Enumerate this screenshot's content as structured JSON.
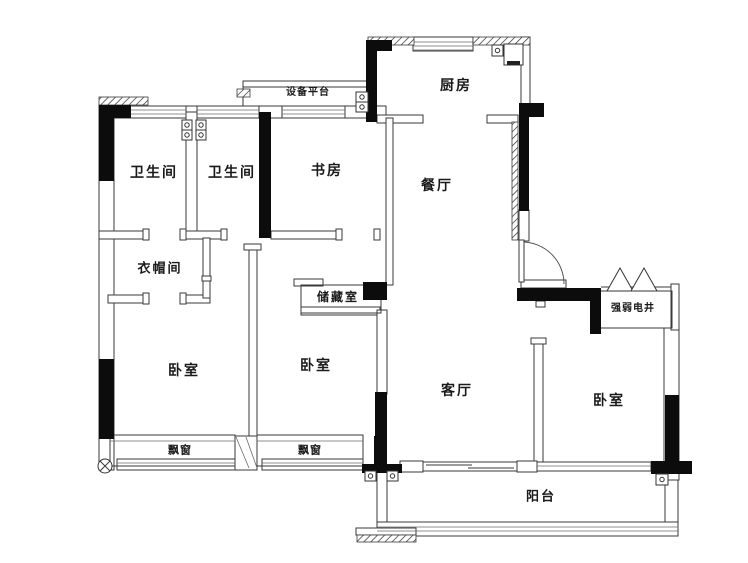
{
  "floorplan": {
    "rooms": {
      "equipment_platform": "设备平台",
      "kitchen": "厨房",
      "bathroom_1": "卫生间",
      "bathroom_2": "卫生间",
      "study": "书房",
      "dining": "餐厅",
      "cloakroom": "衣帽间",
      "storage": "储藏室",
      "utility_shaft": "强弱电井",
      "bedroom_left": "卧室",
      "bedroom_middle": "卧室",
      "bedroom_right": "卧室",
      "living": "客厅",
      "bay_window_left": "飘窗",
      "bay_window_right": "飘窗",
      "balcony": "阳台"
    },
    "colors": {
      "wall": "#0c0c0c",
      "outline": "#3a3a3a",
      "background": "#ffffff",
      "text": "#1a1a1a"
    }
  }
}
